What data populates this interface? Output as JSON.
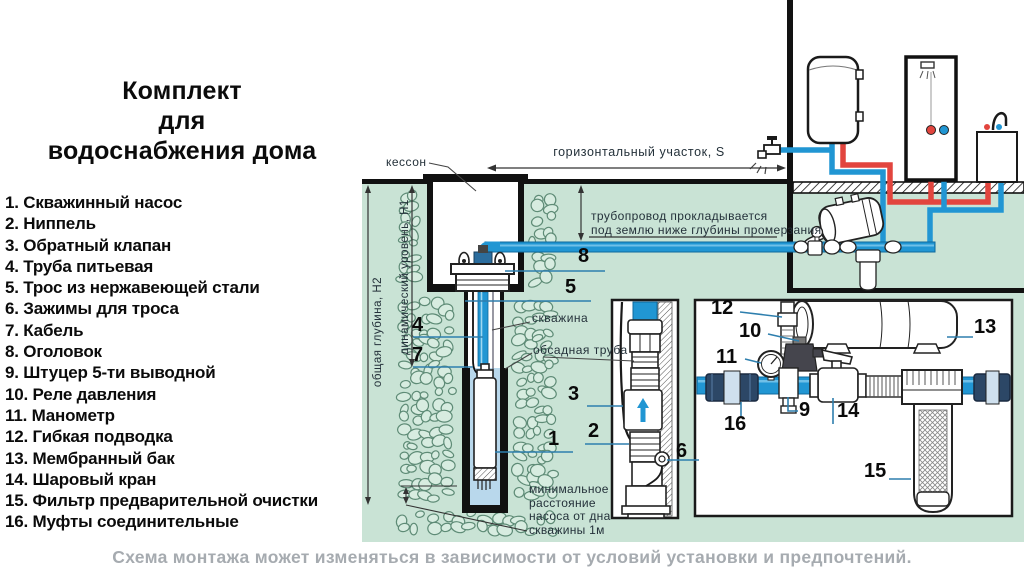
{
  "title": {
    "line1": "Комплект",
    "line2": "для",
    "line3": "водоснабжения дома"
  },
  "legend": {
    "items": [
      {
        "num": "1.",
        "label": "Скважинный насос"
      },
      {
        "num": "2.",
        "label": "Ниппель"
      },
      {
        "num": "3.",
        "label": "Обратный клапан"
      },
      {
        "num": "4.",
        "label": "Труба питьевая"
      },
      {
        "num": "5.",
        "label": "Трос из нержавеющей стали"
      },
      {
        "num": "6.",
        "label": "Зажимы для троса"
      },
      {
        "num": "7.",
        "label": "Кабель"
      },
      {
        "num": "8.",
        "label": "Оголовок"
      },
      {
        "num": "9.",
        "label": "Штуцер 5-ти выводной"
      },
      {
        "num": "10.",
        "label": "Реле давления"
      },
      {
        "num": "11.",
        "label": "Манометр"
      },
      {
        "num": "12.",
        "label": "Гибкая подводка"
      },
      {
        "num": "13.",
        "label": "Мембранный бак"
      },
      {
        "num": "14.",
        "label": "Шаровый кран"
      },
      {
        "num": "15.",
        "label": "Фильтр предварительной очистки"
      },
      {
        "num": "16.",
        "label": "Муфты соединительные"
      }
    ]
  },
  "diagram": {
    "labels": {
      "kesson": "кессон",
      "horizontal_section": "горизонтальный участок,  S",
      "pipeline_note_line1": "трубопровод прокладывается",
      "pipeline_note_line2": "под землю ниже глубины промерзания",
      "well": "скважина",
      "casing_pipe": "обсадная труба",
      "total_depth": "общая глубина, Н2",
      "dynamic_level": "динамический уровень, Н1",
      "min_distance": "минимальное расстояние насоса от дна скважины 1м"
    },
    "part_numbers": [
      "1",
      "2",
      "3",
      "4",
      "5",
      "6",
      "7",
      "8",
      "9",
      "10",
      "11",
      "12",
      "13",
      "14",
      "15",
      "16"
    ]
  },
  "footer": {
    "note": "Схема монтажа может изменяться в зависимости от условий установки и предпочтений."
  },
  "colors": {
    "ground": "#c9e3d5",
    "stone_outline": "#5e8b76",
    "stone_fill": "#d7ece0",
    "pipe_cold": "#2196d3",
    "pipe_cold_edge": "#10699c",
    "pipe_hot": "#e2453e",
    "well_water": "#b9d8ec",
    "leader": "#2e7fae",
    "coupling_dark": "#2c4766"
  }
}
